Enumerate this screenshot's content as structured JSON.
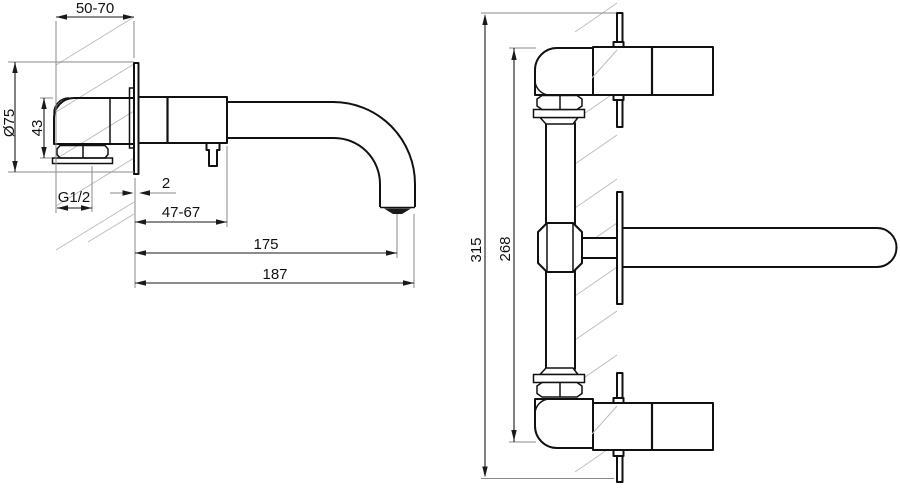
{
  "drawing": {
    "background": "#ffffff",
    "outline_color": "#111111",
    "dimension_color": "#1a1a1a",
    "extension_color": "#8a8a8a",
    "hatch_color": "#bdbdbd",
    "side_view": {
      "wall_depth_range": "50-70",
      "escutcheon_diameter": "Ø75",
      "inlet_height": "43",
      "thread_size": "G1/2",
      "escutcheon_thickness": "2",
      "body_projection_range": "47-67",
      "spout_reach": "175",
      "total_projection": "187"
    },
    "front_view": {
      "total_height": "315",
      "valve_center_distance": "268"
    }
  }
}
